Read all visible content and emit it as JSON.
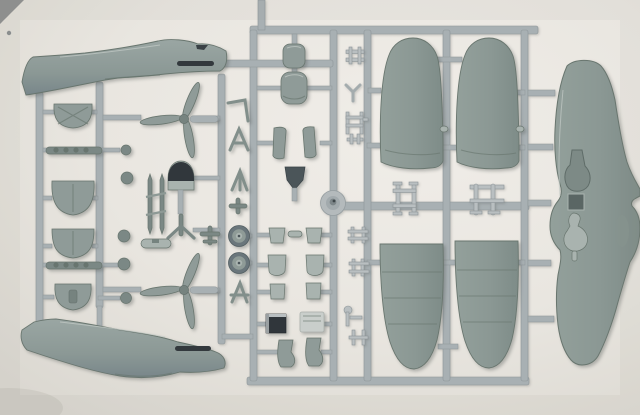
{
  "meta": {
    "title": "Model aircraft kit sprue",
    "alt": "Photograph of a single light gray injection-molded plastic sprue holding unassembled model aircraft parts on a pale paper background"
  },
  "scene": {
    "subject": "plastic model kit sprue with aircraft parts",
    "background": "plain warm light-gray surface, soft vignette, no text visible",
    "parts": [
      "fuselage-half-upper",
      "fuselage-half-lower",
      "three-blade-propeller-upper",
      "three-blade-propeller-lower",
      "upper-wing-panel-left",
      "upper-wing-panel-right",
      "lower-wing-panel-left",
      "lower-wing-panel-right",
      "one-piece-lower-wing-with-wheel-wells",
      "landing-gear-doors",
      "exhaust-stack-rods",
      "main-wheels",
      "cowling-sections",
      "headrest-canopy-piece",
      "radiator-block",
      "small-strut-and-ladder-pieces",
      "spinner-funnel-piece",
      "sprue-gate-boss"
    ]
  },
  "colors": {
    "bg1": "#efece7",
    "bg2": "#e7e4de",
    "bg3": "#d9d6cf",
    "runner": "#a8b0b3",
    "runner-dark": "#8d9598",
    "runner-light": "#b9bfc1",
    "part": "#8f9b98",
    "part-light": "#a9b3af",
    "part-deep": "#7b8885",
    "part-edge": "#69766f",
    "dark": "#30363b",
    "wheel-tire": "#6a767b",
    "wheel-hub": "#9aa5a1"
  }
}
